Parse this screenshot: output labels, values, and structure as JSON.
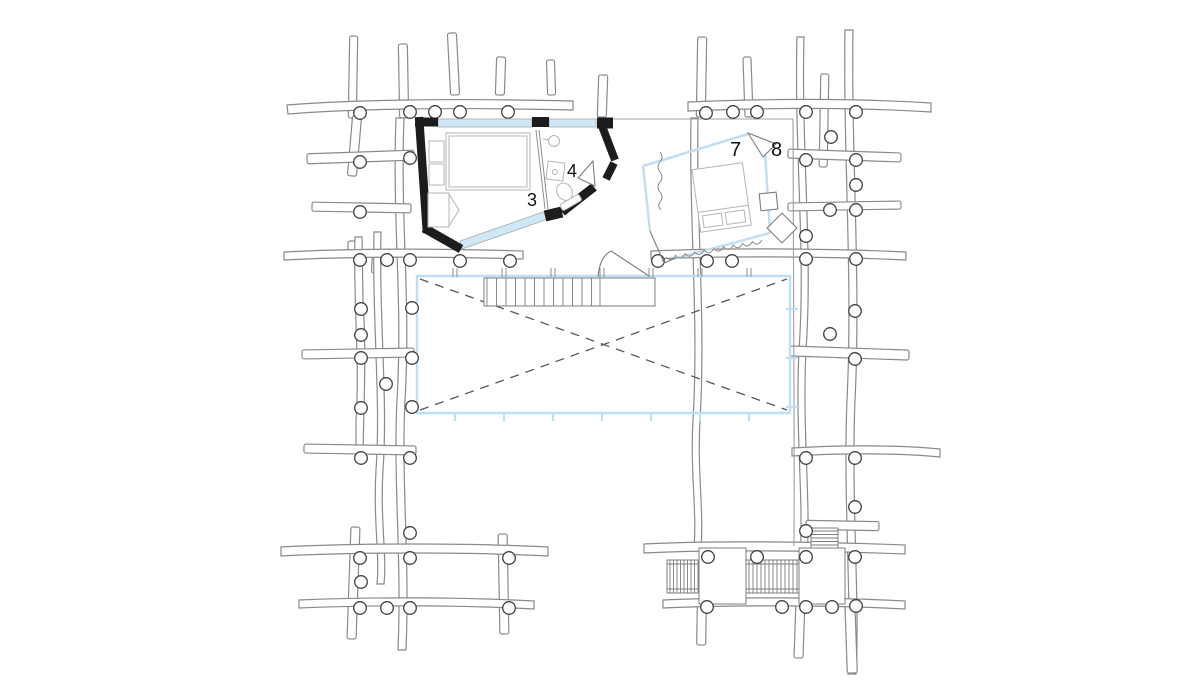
{
  "drawing": {
    "kind": "architectural floor plan, hand-drawn timber log structure with two rooms, central void and stairs"
  },
  "rooms": [
    {
      "id": "room-3",
      "label": "3"
    },
    {
      "id": "room-4",
      "label": "4"
    },
    {
      "id": "room-7",
      "label": "7"
    },
    {
      "id": "room-8",
      "label": "8"
    }
  ],
  "colors": {
    "walls": "#1c1c1c",
    "timber_outline": "#8a8a8a",
    "deck_edge": "#9f9f9f",
    "glazing": "#cfe8f7",
    "glazing_outline": "#bfe0f2",
    "cross_brace_dash": "#575757",
    "furniture": "#b5b5b5",
    "label_text": "#111111",
    "background": "#ffffff"
  }
}
